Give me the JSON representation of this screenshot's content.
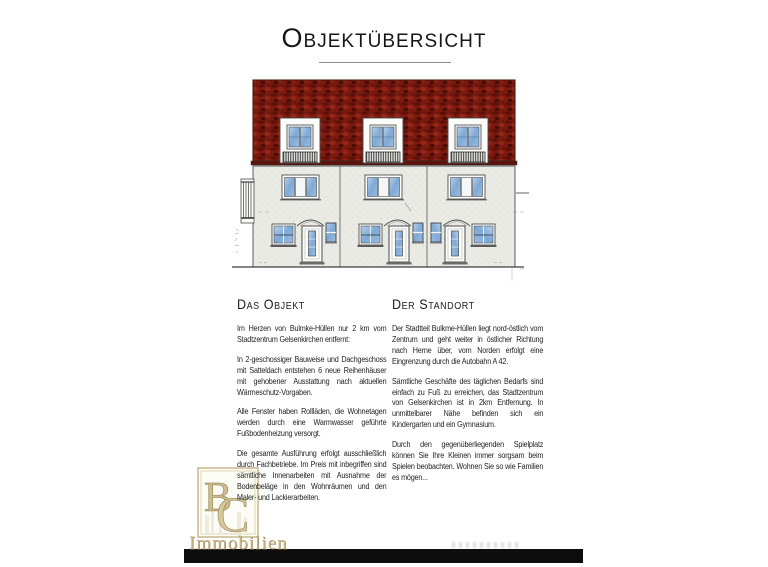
{
  "page": {
    "title": "Objektübersicht",
    "background": "#ffffff"
  },
  "drawing": {
    "label": "building-front-elevation",
    "units": 3,
    "colors": {
      "roof": "#7d1a10",
      "facade": "#ebebe6",
      "glass": "#7fa9d6",
      "outline": "#4a4a4a"
    }
  },
  "columns": {
    "object": {
      "heading": "Das Objekt",
      "paragraphs": [
        "Im Herzen von Bulmke-Hüllen nur 2 km vom Stadtzentrum Gelsenkirchen entfernt:",
        "In 2-geschossiger Bauweise und Dachgeschoss mit Satteldach entstehen 6 neue Reihenhäuser mit gehobener Ausstattung nach aktuellen Wärmeschutz-Vorgaben.",
        "Alle Fenster haben Rollläden, die Wohnetagen werden durch eine Warmwasser geführte Fußbodenheizung versorgt.",
        "Die gesamte Ausführung erfolgt ausschließlich durch Fachbetriebe. Im Preis mit inbegriffen sind sämtliche Innenarbeiten mit Ausnahme der Bodenbeläge in den Wohnräumen und den Maler- und Lackierarbeiten."
      ]
    },
    "standort": {
      "heading": "Der Standort",
      "paragraphs": [
        "Der Stadtteil Bulkme-Hüllen liegt nord-östlich vom Zentrum und geht weiter in östlicher Richtung nach Herne über, vom Norden erfolgt eine Eingrenzung durch die Autobahn A 42.",
        "Sämtliche Geschäfte des täglichen Bedarfs sind einfach zu Fuß zu erreichen, das Stadtzentrum von Gelsenkirchen ist in 2km Entfernung. In unmittelbarer Nähe befinden sich ein Kindergarten und ein Gymnasium.",
        "Durch den gegenüberliegenden Spielplatz können Sie Ihre Kleinen immer sorgsam beim Spielen beobachten. Wohnen Sie so wie Familien es mögen..."
      ]
    }
  },
  "logo": {
    "monogram_b": "B",
    "monogram_c": "C",
    "text": "Immobilien",
    "gold": "#c6b383"
  },
  "footer": {
    "bar_color": "#0d0d0d"
  }
}
